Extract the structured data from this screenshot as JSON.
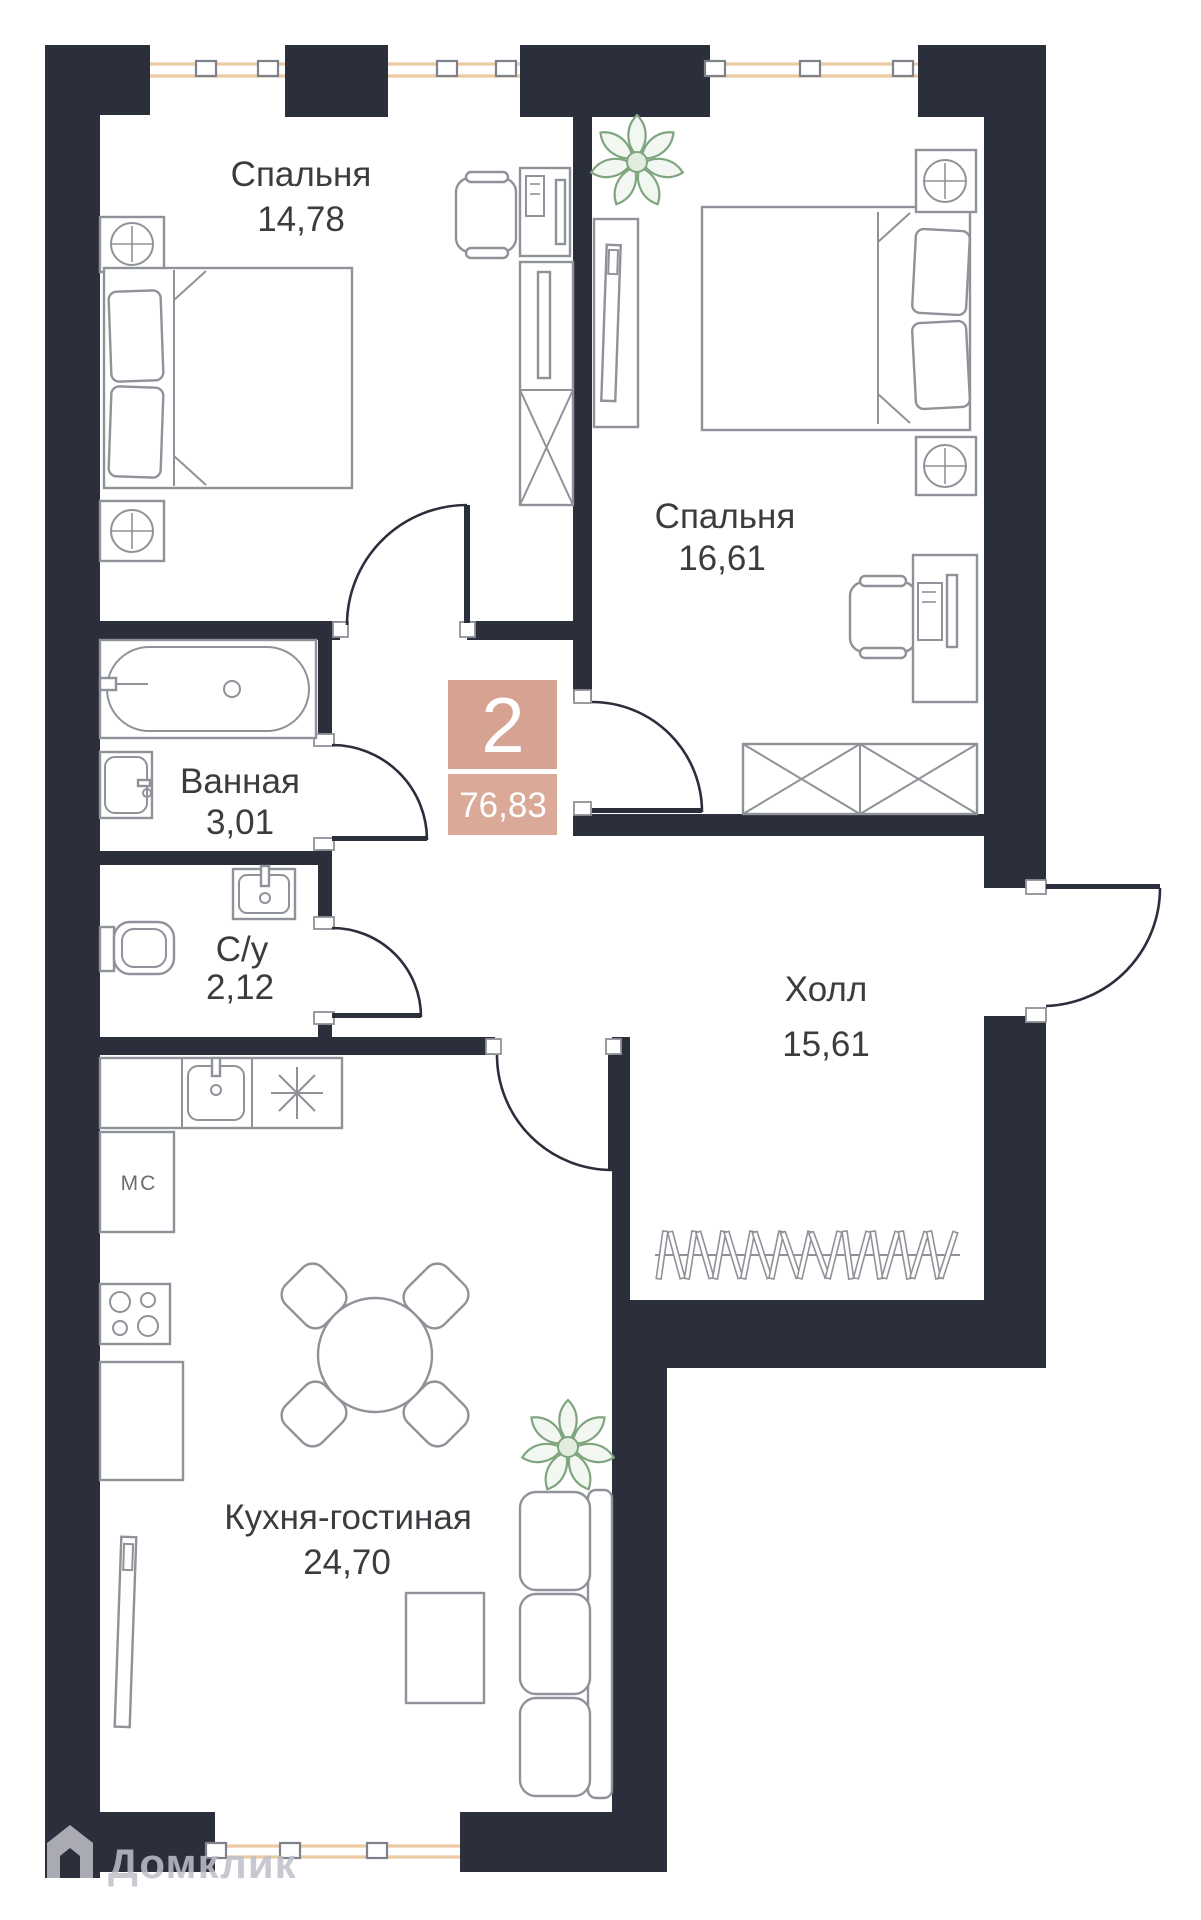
{
  "plan": {
    "badge": {
      "rooms_count": "2",
      "total_area": "76,83"
    },
    "rooms": [
      {
        "id": "bedroom-1",
        "name": "Спальня",
        "area": "14,78"
      },
      {
        "id": "bedroom-2",
        "name": "Спальня",
        "area": "16,61"
      },
      {
        "id": "bathroom",
        "name": "Ванная",
        "area": "3,01"
      },
      {
        "id": "wc",
        "name": "С/у",
        "area": "2,12"
      },
      {
        "id": "hall",
        "name": "Холл",
        "area": "15,61"
      },
      {
        "id": "kitchen-living",
        "name": "Кухня-гостиная",
        "area": "24,70"
      }
    ],
    "kitchen_appliance_label": "МС",
    "watermark": "Домклик",
    "colors": {
      "wall": "#2b2e3b",
      "furniture": "#8f9298",
      "window": "#eccaa2",
      "badge_top": "#d6a292",
      "badge_bottom": "#daa998",
      "plant": "#7fa57e",
      "text": "#3b3c40",
      "muted": "#6b6c70",
      "watermark": "#bfc0c8"
    }
  }
}
